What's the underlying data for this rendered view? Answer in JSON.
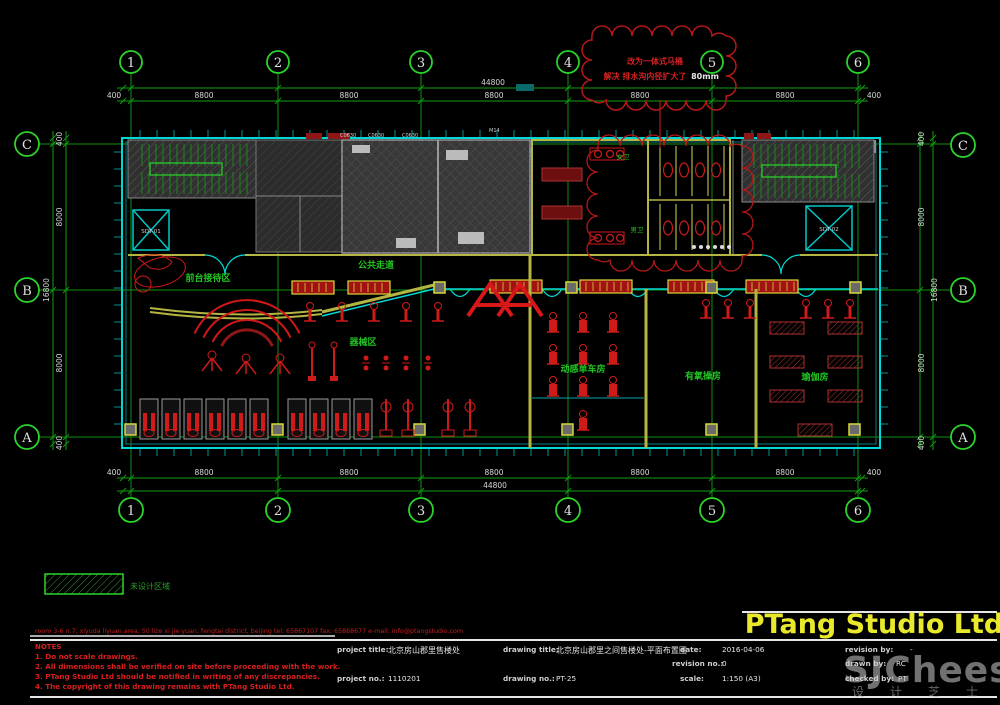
{
  "studio": "PTang Studio Ltd",
  "watermark": {
    "brand": "SJCheese",
    "caption": "设计芝士"
  },
  "grid": {
    "cols": [
      "1",
      "2",
      "3",
      "4",
      "5",
      "6"
    ],
    "rows": [
      "C",
      "B",
      "A"
    ]
  },
  "dims": {
    "h_overall": "44800",
    "h_segments": [
      "400",
      "8800",
      "8800",
      "8800",
      "8800",
      "8800",
      "400"
    ],
    "v_overall": "16800",
    "v_segments": [
      "400",
      "8000",
      "8000",
      "400"
    ]
  },
  "cloud_note": {
    "line1": "改为一体式马桶",
    "line2": "解决 排水沟内径扩大了",
    "highlight": "80mm"
  },
  "rooms": {
    "reception": "前台接待区",
    "corridor": "公共走道",
    "equipment": "器械区",
    "spinning": "动感单车房",
    "aerobics": "有氧操房",
    "yoga": "瑜伽房",
    "toilet_f": "女卫",
    "toilet_m": "男卫"
  },
  "elevators": {
    "left": "SDT-01",
    "right": "SDT-02"
  },
  "tags": {
    "window": "C0630",
    "door": "M14"
  },
  "legend": {
    "label": "未设计区域"
  },
  "footer": {
    "address": "room 3-6 n.7, xiyuda liyuan area, 50 lize xi jie yuan, fengtai district, beijing   tel: 65867107   fax: 65868677   e-mail: info@ptangstudio.com",
    "notes_header": "NOTES",
    "notes": [
      "1. Do not scale drawings.",
      "2. All dimensions shall be verified on site before proceeding with the work.",
      "3. PTang Studio Ltd should be notified in writing of any discrepancies.",
      "4. The copyright of this drawing remains with PTang Studio Ltd."
    ]
  },
  "titleblock": {
    "project_title_label": "project title:",
    "project_title": "北京房山郡里售楼处",
    "drawing_title_label": "drawing title:",
    "drawing_title": "北京房山郡里之间售楼处-平面布置图",
    "date_label": "date:",
    "date": "2016-04-06",
    "revision_by_label": "revision by:",
    "revision_by": "-",
    "revision_no_label": "revision no.:",
    "revision_no": "0",
    "drawn_by_label": "drawn by:",
    "drawn_by": "RC",
    "project_no_label": "project no.:",
    "project_no": "1110201",
    "drawing_no_label": "drawing no.:",
    "drawing_no": "PT-25",
    "scale_label": "scale:",
    "scale": "1:150 (A3)",
    "checked_by_label": "checked by:",
    "checked_by": "PT"
  },
  "colors": {
    "grid_green": "#12a212",
    "wall_cyan": "#00d9d9",
    "wall_yellow": "#b5b543",
    "equip_red": "#cf1a1a",
    "title_yellow": "#e9e92b",
    "note_red": "#d71f1f"
  }
}
